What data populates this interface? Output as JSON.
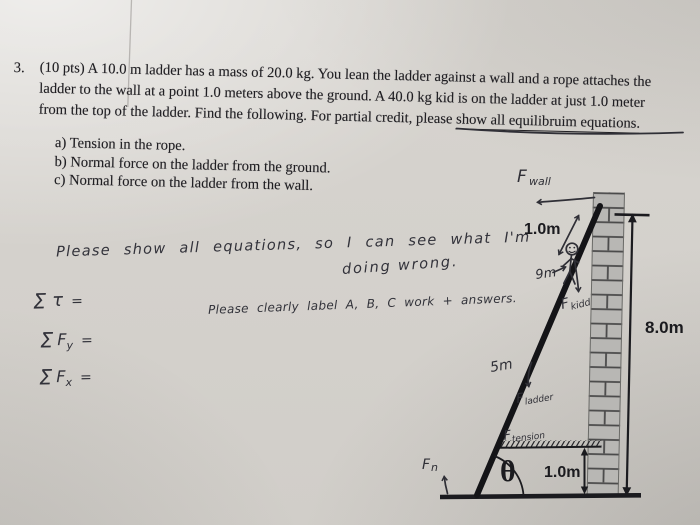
{
  "problem": {
    "number": "3.",
    "line1": "(10 pts) A 10.0 m ladder has a mass of 20.0 kg.  You lean the ladder against a wall and a rope attaches the",
    "line2": "ladder to the wall at a point 1.0 meters above the ground.  A 40.0 kg kid is on the ladder at just 1.0 meter",
    "line3_before": "from the top of the ladder.  Find the following.  For partial credit, please ",
    "line3_underlined": "show all equilibruim equations.",
    "items": [
      "a) Tension in the rope.",
      "b) Normal force on the ladder from the ground.",
      "c) Normal force on the ladder from the wall."
    ]
  },
  "handwriting": {
    "note1": "Please show all equations, so I can see what I'm",
    "note2": "doing wrong.",
    "note3": "Please clearly label A, B, C work + answers.",
    "torque": {
      "sigma": "Σ",
      "symbol": "τ",
      "equals": "="
    },
    "fy": {
      "sigma": "Σ",
      "f": "F",
      "sub": "y",
      "equals": "="
    },
    "fx": {
      "sigma": "Σ",
      "f": "F",
      "sub": "x",
      "equals": "="
    }
  },
  "diagram": {
    "forces": {
      "wall": {
        "main": "F",
        "sub": "wall"
      },
      "kid": {
        "main": "F",
        "sub": "kidd"
      },
      "ladder": {
        "main": "F",
        "sub": "ladder"
      },
      "tension": {
        "main": "F",
        "sub": "tension"
      },
      "normal": {
        "main": "F",
        "sub": "n"
      }
    },
    "measurements": {
      "top_segment": "1.0m",
      "kid_distance": "9m",
      "mid_distance": "5m",
      "wall_height": "8.0m",
      "rope_height": "1.0m",
      "angle": "θ"
    },
    "colors": {
      "printed_ink": "#1b1b1f",
      "hand_ink": "#2f2f36",
      "paper": "#d5d2cd",
      "brick": "#b8b7b4"
    }
  }
}
